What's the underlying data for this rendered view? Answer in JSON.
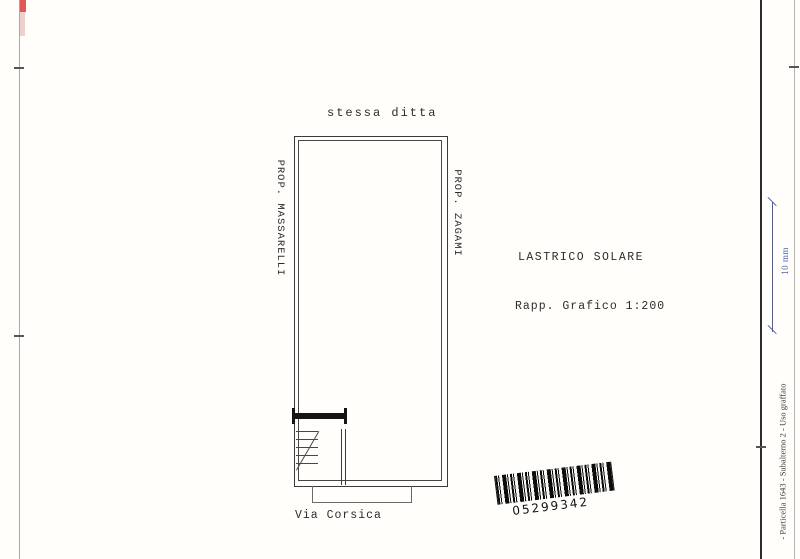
{
  "page": {
    "top_label": "stessa ditta",
    "plan": {
      "left_owner_label": "PROP. MASSARELLI",
      "right_owner_label": "PROP. ZAGAMI",
      "area_label": "LASTRICO SOLARE",
      "scale_label": "Rapp. Grafico 1:200",
      "street_label": "Via Corsica"
    },
    "barcode": {
      "number": "05299342"
    },
    "margin": {
      "dimension_label": "10 mm",
      "side_note": "- Particella 1643 - Subalterno 2 - Uso graffato"
    },
    "colors": {
      "dimension_blue": "#4a5fb5",
      "stamp_red": "#df5a52",
      "ink": "#2e2e2e",
      "paper": "#fffefa"
    }
  }
}
